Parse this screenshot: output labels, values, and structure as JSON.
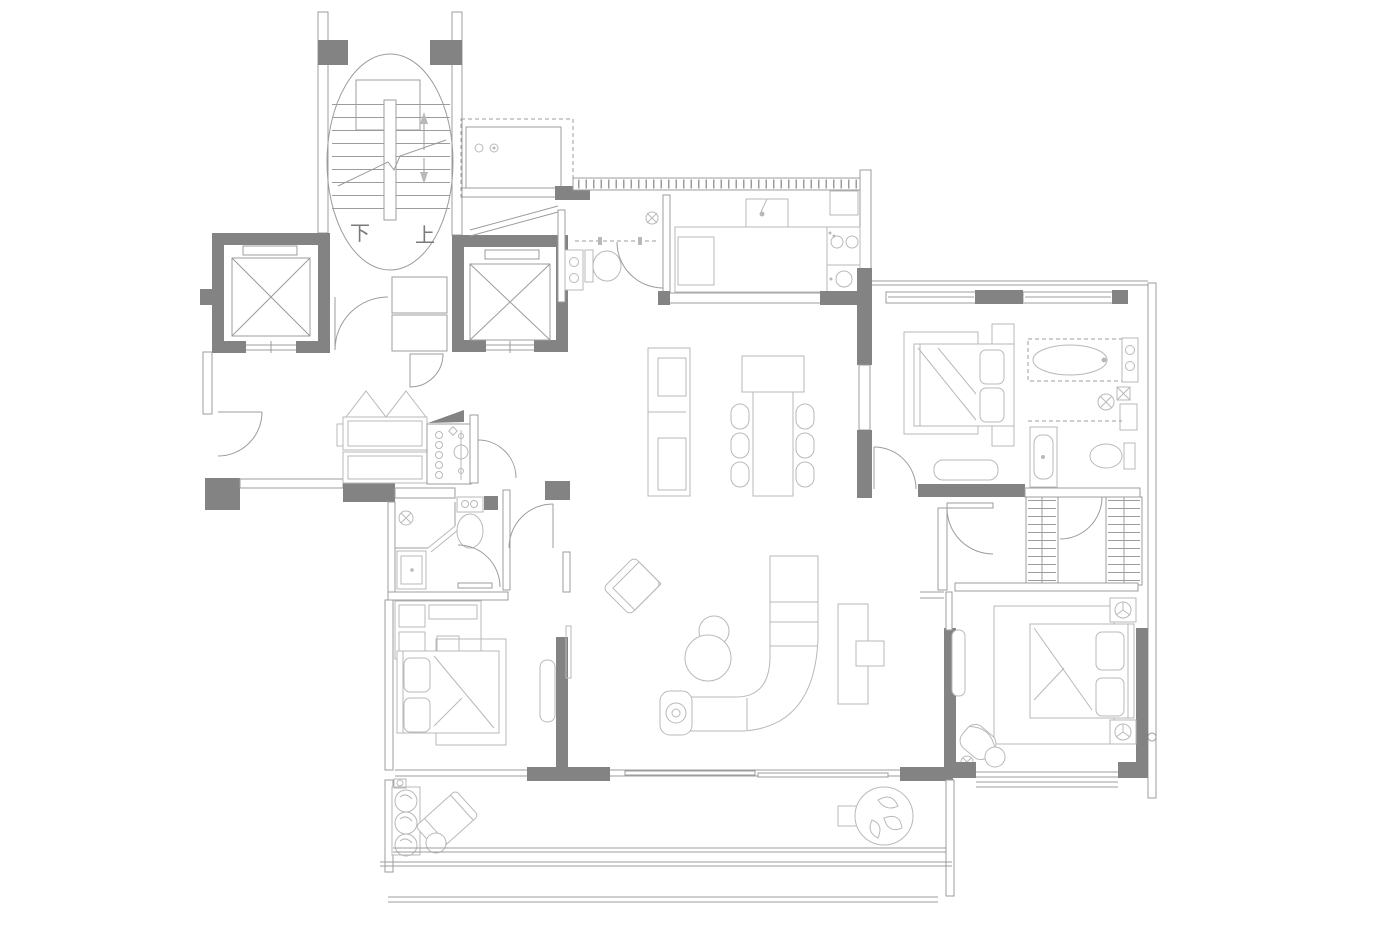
{
  "colors": {
    "bg": "#ffffff",
    "wall": "#838383",
    "line": "#9c9c9c",
    "soft": "#b9b9b9",
    "text": "#7a7a7a"
  },
  "stairwell": {
    "down_label": "下",
    "up_label": "上"
  }
}
